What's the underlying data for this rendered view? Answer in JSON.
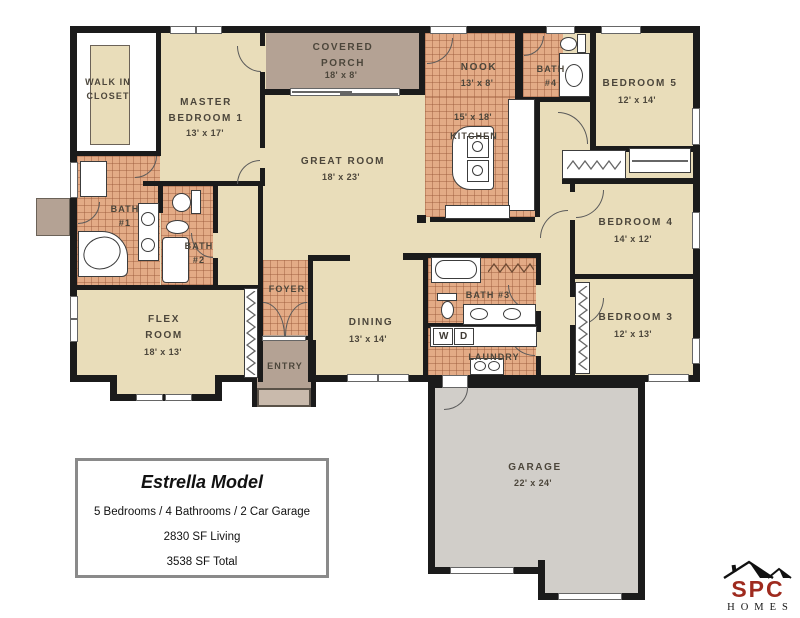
{
  "plan": {
    "rooms": {
      "walk_in_closet": {
        "label": "WALK IN\nCLOSET"
      },
      "master_bedroom": {
        "label": "MASTER\nBEDROOM 1",
        "dims": "13' x 17'"
      },
      "covered_porch": {
        "label": "COVERED\nPORCH",
        "dims": "18' x 8'"
      },
      "great_room": {
        "label": "GREAT ROOM",
        "dims": "18' x 23'"
      },
      "nook": {
        "label": "NOOK",
        "dims": "13' x 8'"
      },
      "kitchen": {
        "label": "KITCHEN",
        "dims": "15' x 18'"
      },
      "bath_4": {
        "label": "BATH\n#4"
      },
      "bedroom_5": {
        "label": "BEDROOM 5",
        "dims": "12' x 14'"
      },
      "bath_1": {
        "label": "BATH\n#1"
      },
      "bath_2": {
        "label": "BATH\n#2"
      },
      "bedroom_4": {
        "label": "BEDROOM 4",
        "dims": "14' x 12'"
      },
      "flex_room": {
        "label": "FLEX\nROOM",
        "dims": "18' x 13'"
      },
      "foyer": {
        "label": "FOYER"
      },
      "dining": {
        "label": "DINING",
        "dims": "13' x 14'"
      },
      "bath_3": {
        "label": "BATH #3"
      },
      "laundry": {
        "label": "LAUNDRY"
      },
      "washer": "W",
      "dryer": "D",
      "entry": {
        "label": "ENTRY"
      },
      "bedroom_3": {
        "label": "BEDROOM 3",
        "dims": "12' x 13'"
      },
      "garage": {
        "label": "GARAGE",
        "dims": "22' x 24'"
      }
    }
  },
  "info_box": {
    "title": "Estrella Model",
    "line1": "5 Bedrooms / 4 Bathrooms / 2 Car Garage",
    "line2": "2830 SF Living",
    "line3": "3538 SF Total"
  },
  "logo": {
    "name": "SPC",
    "sub": "HOMES"
  },
  "colors": {
    "floor": "#e9ddba",
    "tile": "#e3ab86",
    "porch_entry": "#b4a294",
    "garage": "#d1cec9",
    "wall": "#1b1b1b",
    "logo_red": "#9e2a1e"
  }
}
